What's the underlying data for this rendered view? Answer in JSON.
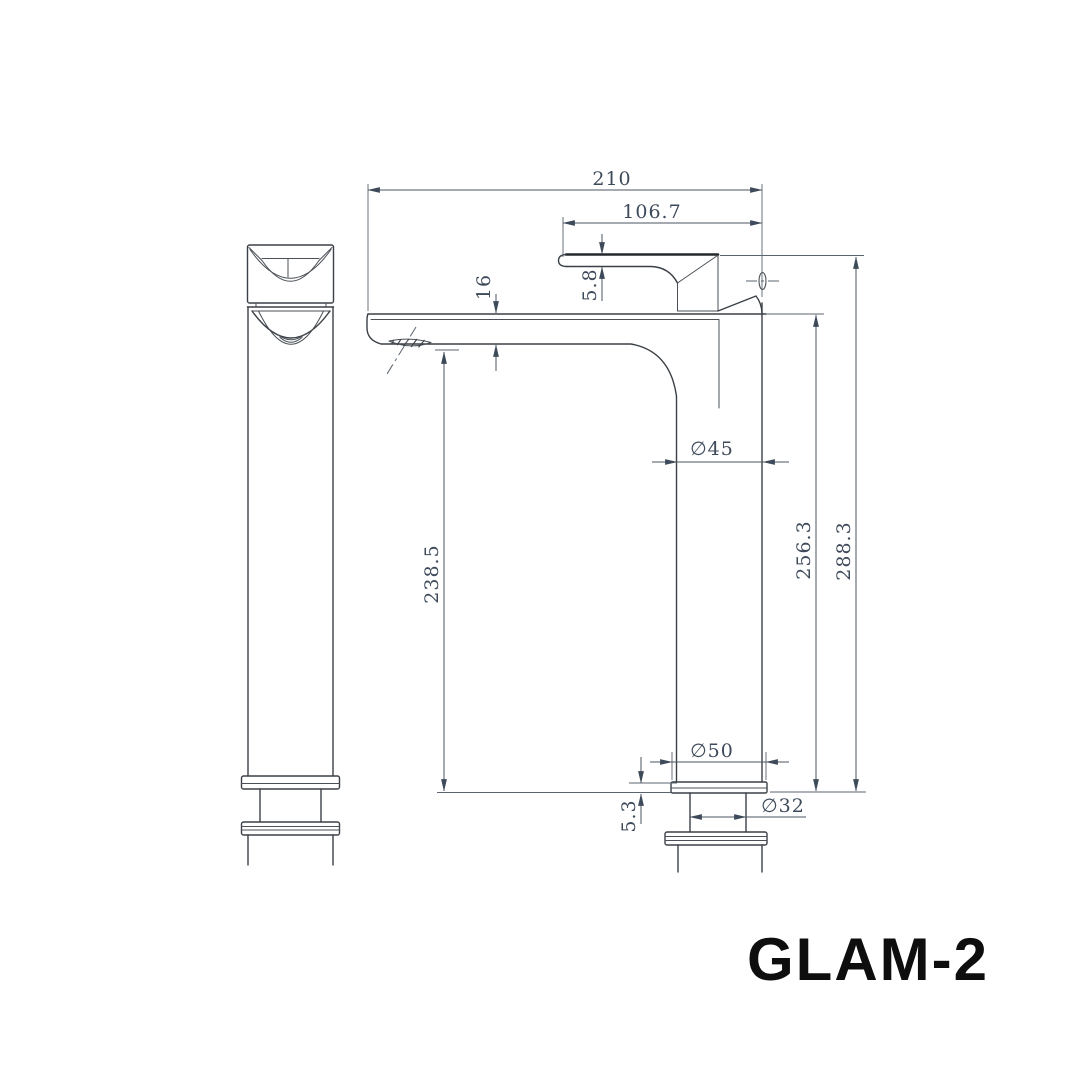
{
  "title": "GLAM-2",
  "dimensions": {
    "total_width": "210",
    "handle_length": "106.7",
    "spout_tip_thickness": "16",
    "handle_thickness": "5.8",
    "body_diameter": "∅45",
    "spout_height": "238.5",
    "body_height": "256.3",
    "total_height": "288.3",
    "base_diameter": "∅50",
    "shank_diameter": "∅32",
    "flange_thickness": "5.3"
  }
}
